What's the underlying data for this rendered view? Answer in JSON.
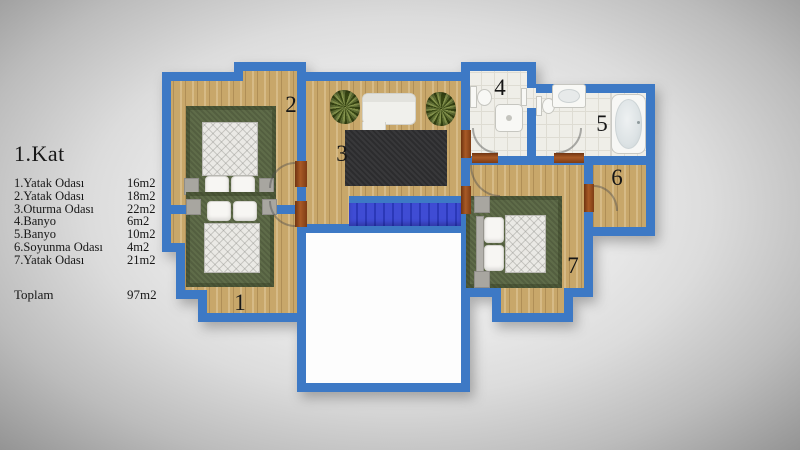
{
  "title": "1.Kat",
  "legend": {
    "items": [
      {
        "label": "1.Yatak Odası",
        "area": "16m2"
      },
      {
        "label": "2.Yatak Odası",
        "area": "18m2"
      },
      {
        "label": "3.Oturma Odası",
        "area": "22m2"
      },
      {
        "label": "4.Banyo",
        "area": "6m2"
      },
      {
        "label": "5.Banyo",
        "area": "10m2"
      },
      {
        "label": "6.Soyunma Odası",
        "area": "4m2"
      },
      {
        "label": "7.Yatak Odası",
        "area": "21m2"
      }
    ],
    "total_label": "Toplam",
    "total_area": "97m2"
  },
  "plan": {
    "rooms": [
      {
        "number": "1",
        "name": "Yatak Odası"
      },
      {
        "number": "2",
        "name": "Yatak Odası"
      },
      {
        "number": "3",
        "name": "Oturma Odası"
      },
      {
        "number": "4",
        "name": "Banyo"
      },
      {
        "number": "5",
        "name": "Banyo"
      },
      {
        "number": "6",
        "name": "Soyunma Odası"
      },
      {
        "number": "7",
        "name": "Yatak Odası"
      }
    ]
  },
  "colors": {
    "wall": "#3d79c5",
    "stairs": "#3742cd",
    "wood": "#c8a76a",
    "rug_green": "#5f6c49",
    "rug_dark": "#2c2c2e",
    "door": "#96541f",
    "background": "#e9e9e9"
  }
}
